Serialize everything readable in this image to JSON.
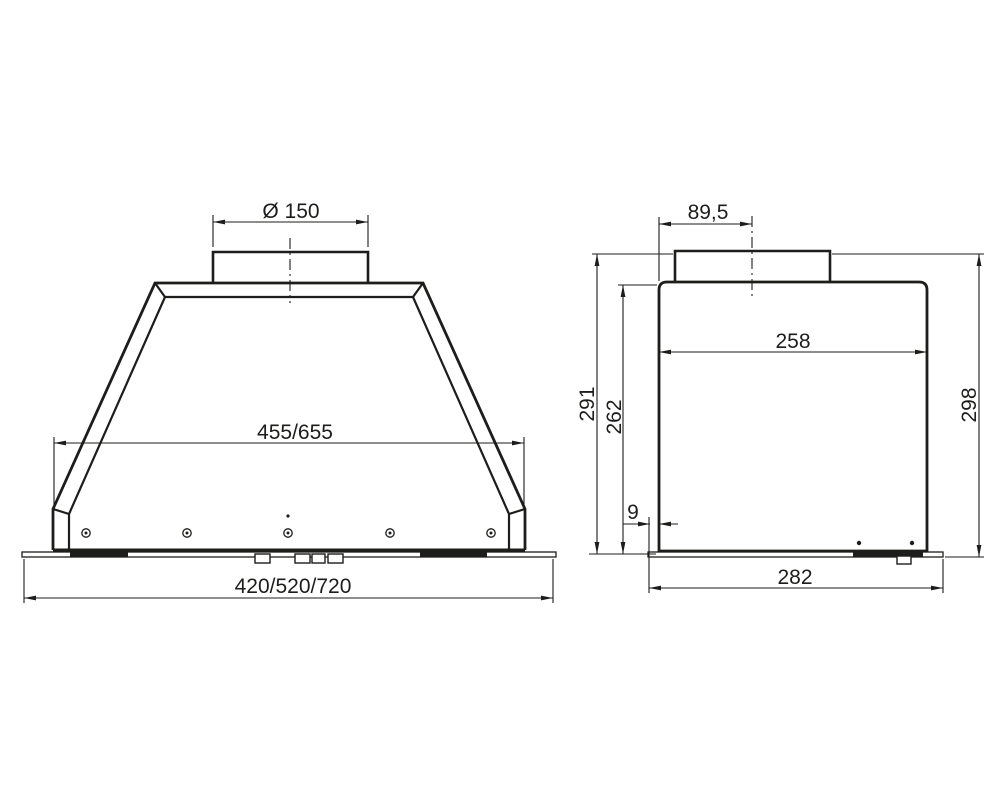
{
  "colors": {
    "background": "#ffffff",
    "line": "#1d1d1b"
  },
  "drawing": {
    "front_view": {
      "dims": {
        "duct_diameter": "Ø 150",
        "inner_width": "455/655",
        "overall_width": "420/520/720"
      }
    },
    "side_view": {
      "dims": {
        "duct_center_offset": "89,5",
        "body_depth": "258",
        "duct_height": "291",
        "body_height": "262",
        "front_lip": "9",
        "overall_depth": "282",
        "overall_height": "298"
      }
    }
  }
}
